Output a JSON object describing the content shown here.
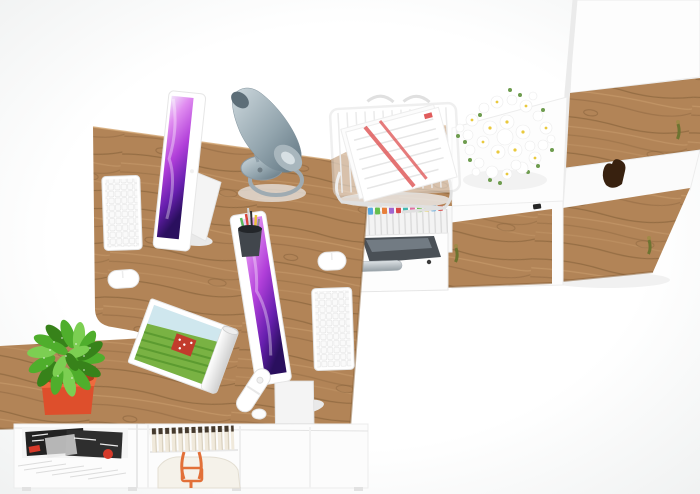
{
  "meta": {
    "kind": "3d-furniture-render",
    "view": "top-down bird's-eye",
    "subject": "two-person oak and white modular office workstation"
  },
  "objects": {
    "desk": "L-shaped oak double desk",
    "monitor_left": "white all-in-one monitor with purple wallpaper",
    "monitor_right": "white all-in-one monitor with purple wallpaper",
    "keyboard_left": "white wireless keyboard",
    "keyboard_right": "white wireless keyboard",
    "mouse_left": "white mouse",
    "mouse_right": "white mouse",
    "lamp": "steel cone desk lamp",
    "pen_cup": "black pen cup with pens",
    "wire_tray": "white wire document stand with red-striped papers",
    "magazine_roll": "rolled magazine with green landscape cover",
    "remote": "white remote control",
    "plant": "green potted plant in orange square pot",
    "flowers": "white daisy bouquet on sideboard",
    "sideboard": "white sideboard with oak doors and keys",
    "tall_cabinet": "tall white cabinet with oak doors and keys",
    "binder_shelf": "shelf of white binders with colored index tabs",
    "printer_bay": "compartment with dark printer and chrome handle",
    "lower_shelf": "low shelf with magazines, books and orange-strap bag",
    "gloves": "dark brown leather item on cabinet shelf"
  },
  "colors": {
    "bg_center": "#ffffff",
    "bg_edge": "#edefef",
    "wood": "#b28457",
    "wood_grain_dark": "#7e5a35",
    "wood_grain_light": "#d3a876",
    "wood_edge": "#8a6137",
    "white_furniture": "#fdfdfd",
    "panel_shadow": "#e7e7e7",
    "screen_top": "#f2e3fb",
    "screen_hi": "#e08cf0",
    "screen_mid": "#b13fd9",
    "screen_deep": "#671fae",
    "screen_dark": "#2a0f5e",
    "steel_light": "#cdd8dd",
    "steel_mid": "#93a5ae",
    "steel_dark": "#5f7480",
    "chrome_light": "#dde2e5",
    "chrome_dark": "#96a0a6",
    "pot_orange": "#de4f2c",
    "pot_rim": "#ef6a3e",
    "pot_inner": "#b03c1c",
    "plant_green": "#4fae2c",
    "plant_green_dark": "#37821a",
    "plant_green_light": "#7ccf52",
    "flower_yellow": "#e9c93d",
    "flower_green": "#6e9c4e",
    "doc_red": "#e05c5c",
    "wire_gray": "#e0e0e0",
    "printer_dark": "#4a5056",
    "printer_light": "#79838b",
    "key_brass": "#a08a48",
    "key_tassel": "#6d7431",
    "glove_brown": "#38210f",
    "magazine_dark": "#222222",
    "magazine_red": "#d63a2a",
    "book_spine": "#f0e9db",
    "book_cap": "#453a2e",
    "bag_orange": "#e27038",
    "bag_body": "#f5f2ea",
    "paper_white": "#ffffff",
    "paper_shade": "#cfcfcf",
    "sky_blue": "#cfe7ee",
    "field_green": "#79b243",
    "field_green_dark": "#55962c",
    "house_red": "#c23b2c",
    "tab_colors": [
      "#e26fa0",
      "#e8c832",
      "#56a8e0",
      "#67bf4d",
      "#e87f3a",
      "#a065d0",
      "#d84848",
      "#44b8b0"
    ],
    "pen_colors": [
      "#d8453a",
      "#2e2e2e",
      "#e8c23a",
      "#5cb85c",
      "#8a8f94",
      "#d5d9dc"
    ]
  }
}
